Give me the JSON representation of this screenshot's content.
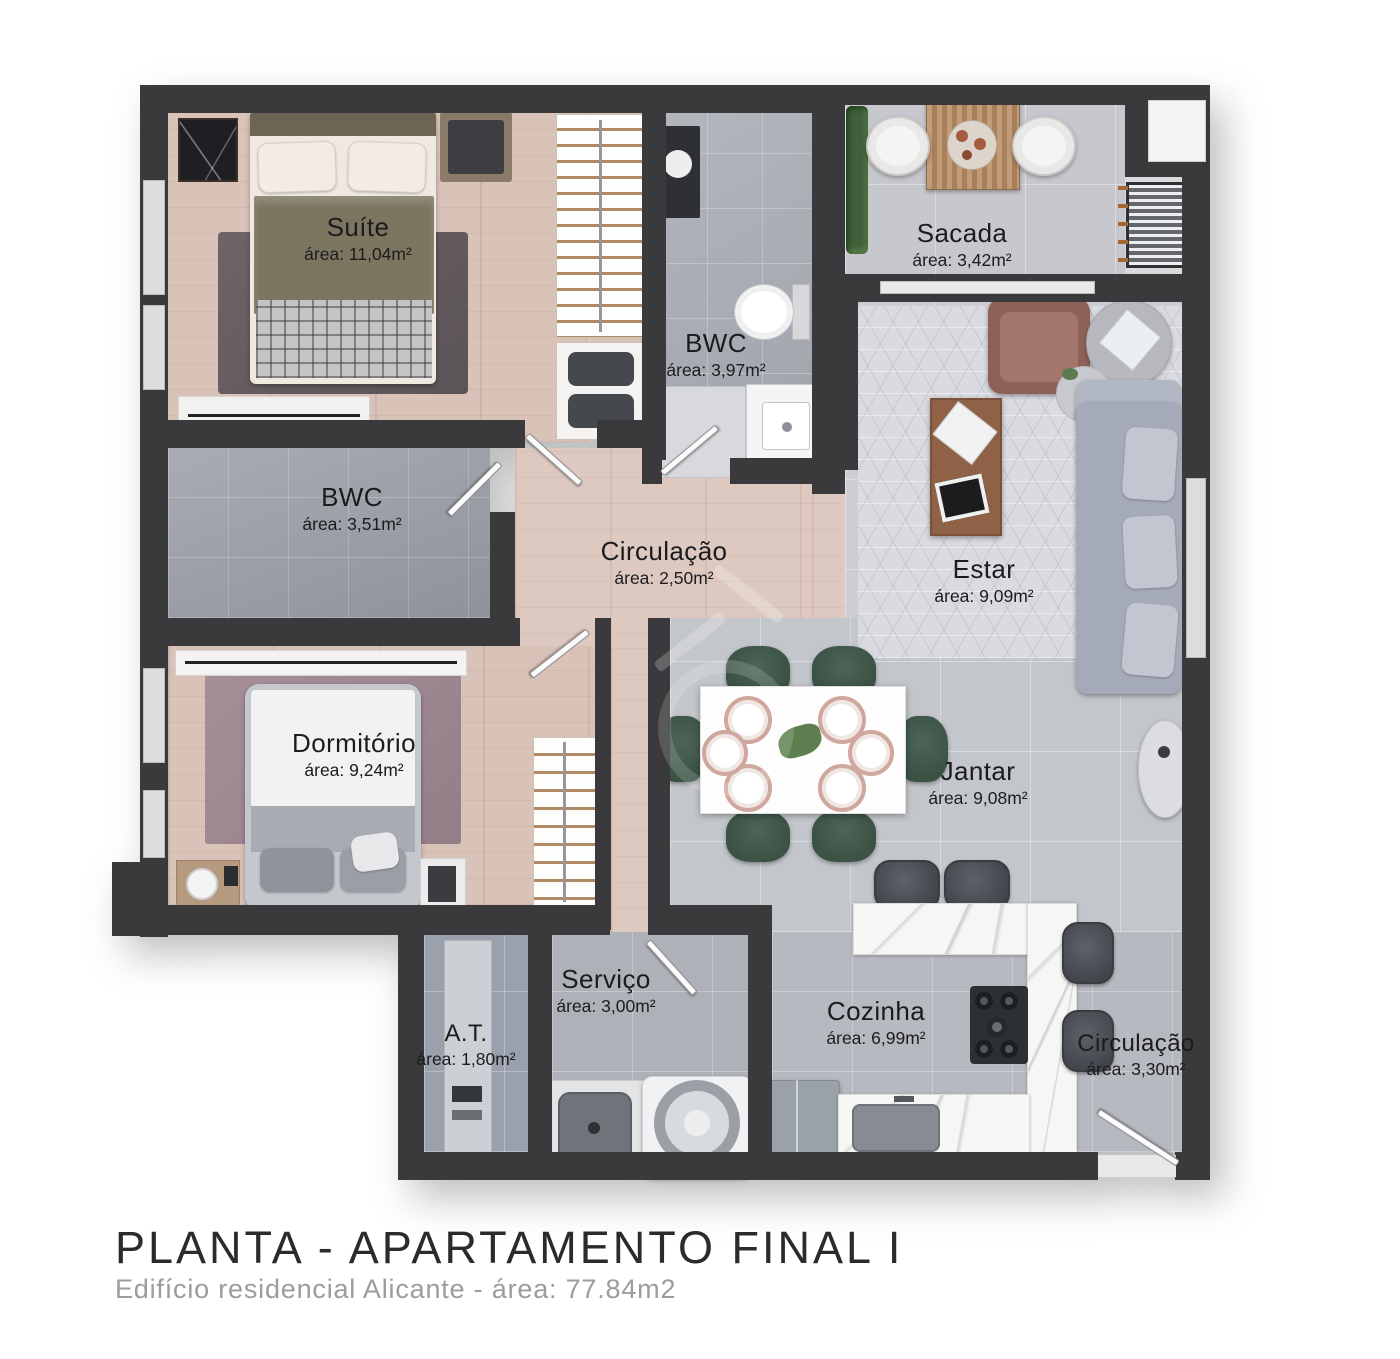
{
  "title_block": {
    "title": "PLANTA - APARTAMENTO FINAL I",
    "subtitle": "Edifício residencial Alicante - área: 77.84m2"
  },
  "rooms": [
    {
      "id": "suite",
      "name": "Suíte",
      "area": "área: 11,04m²"
    },
    {
      "id": "bwc_suite",
      "name": "BWC",
      "area": "área: 3,97m²"
    },
    {
      "id": "sacada",
      "name": "Sacada",
      "area": "área: 3,42m²"
    },
    {
      "id": "bwc_social",
      "name": "BWC",
      "area": "área: 3,51m²"
    },
    {
      "id": "circulacao",
      "name": "Circulação",
      "area": "área: 2,50m²"
    },
    {
      "id": "estar",
      "name": "Estar",
      "area": "área: 9,09m²"
    },
    {
      "id": "dormitorio",
      "name": "Dormitório",
      "area": "área: 9,24m²"
    },
    {
      "id": "jantar",
      "name": "Jantar",
      "area": "área: 9,08m²"
    },
    {
      "id": "servico",
      "name": "Serviço",
      "area": "área: 3,00m²"
    },
    {
      "id": "area_tecnica",
      "name": "A.T.",
      "area": "área: 1,80m²"
    },
    {
      "id": "cozinha",
      "name": "Cozinha",
      "area": "área: 6,99m²"
    },
    {
      "id": "circulacao_entrada",
      "name": "Circulação",
      "area": "área: 3,30m²"
    }
  ],
  "colors": {
    "wall": "#3a3a3d",
    "wood_floor": "#d9c2b8",
    "gray_tile": "#c6c8cd",
    "marble_counter": "#f6f6f4",
    "dining_chair_green": "#3a5144",
    "sofa_gray": "#a5aab8",
    "armchair_brown": "#8d6157",
    "label_text": "#1c1c1e",
    "title_text": "#2b2b2b",
    "subtitle_text": "#9c9c9c"
  }
}
